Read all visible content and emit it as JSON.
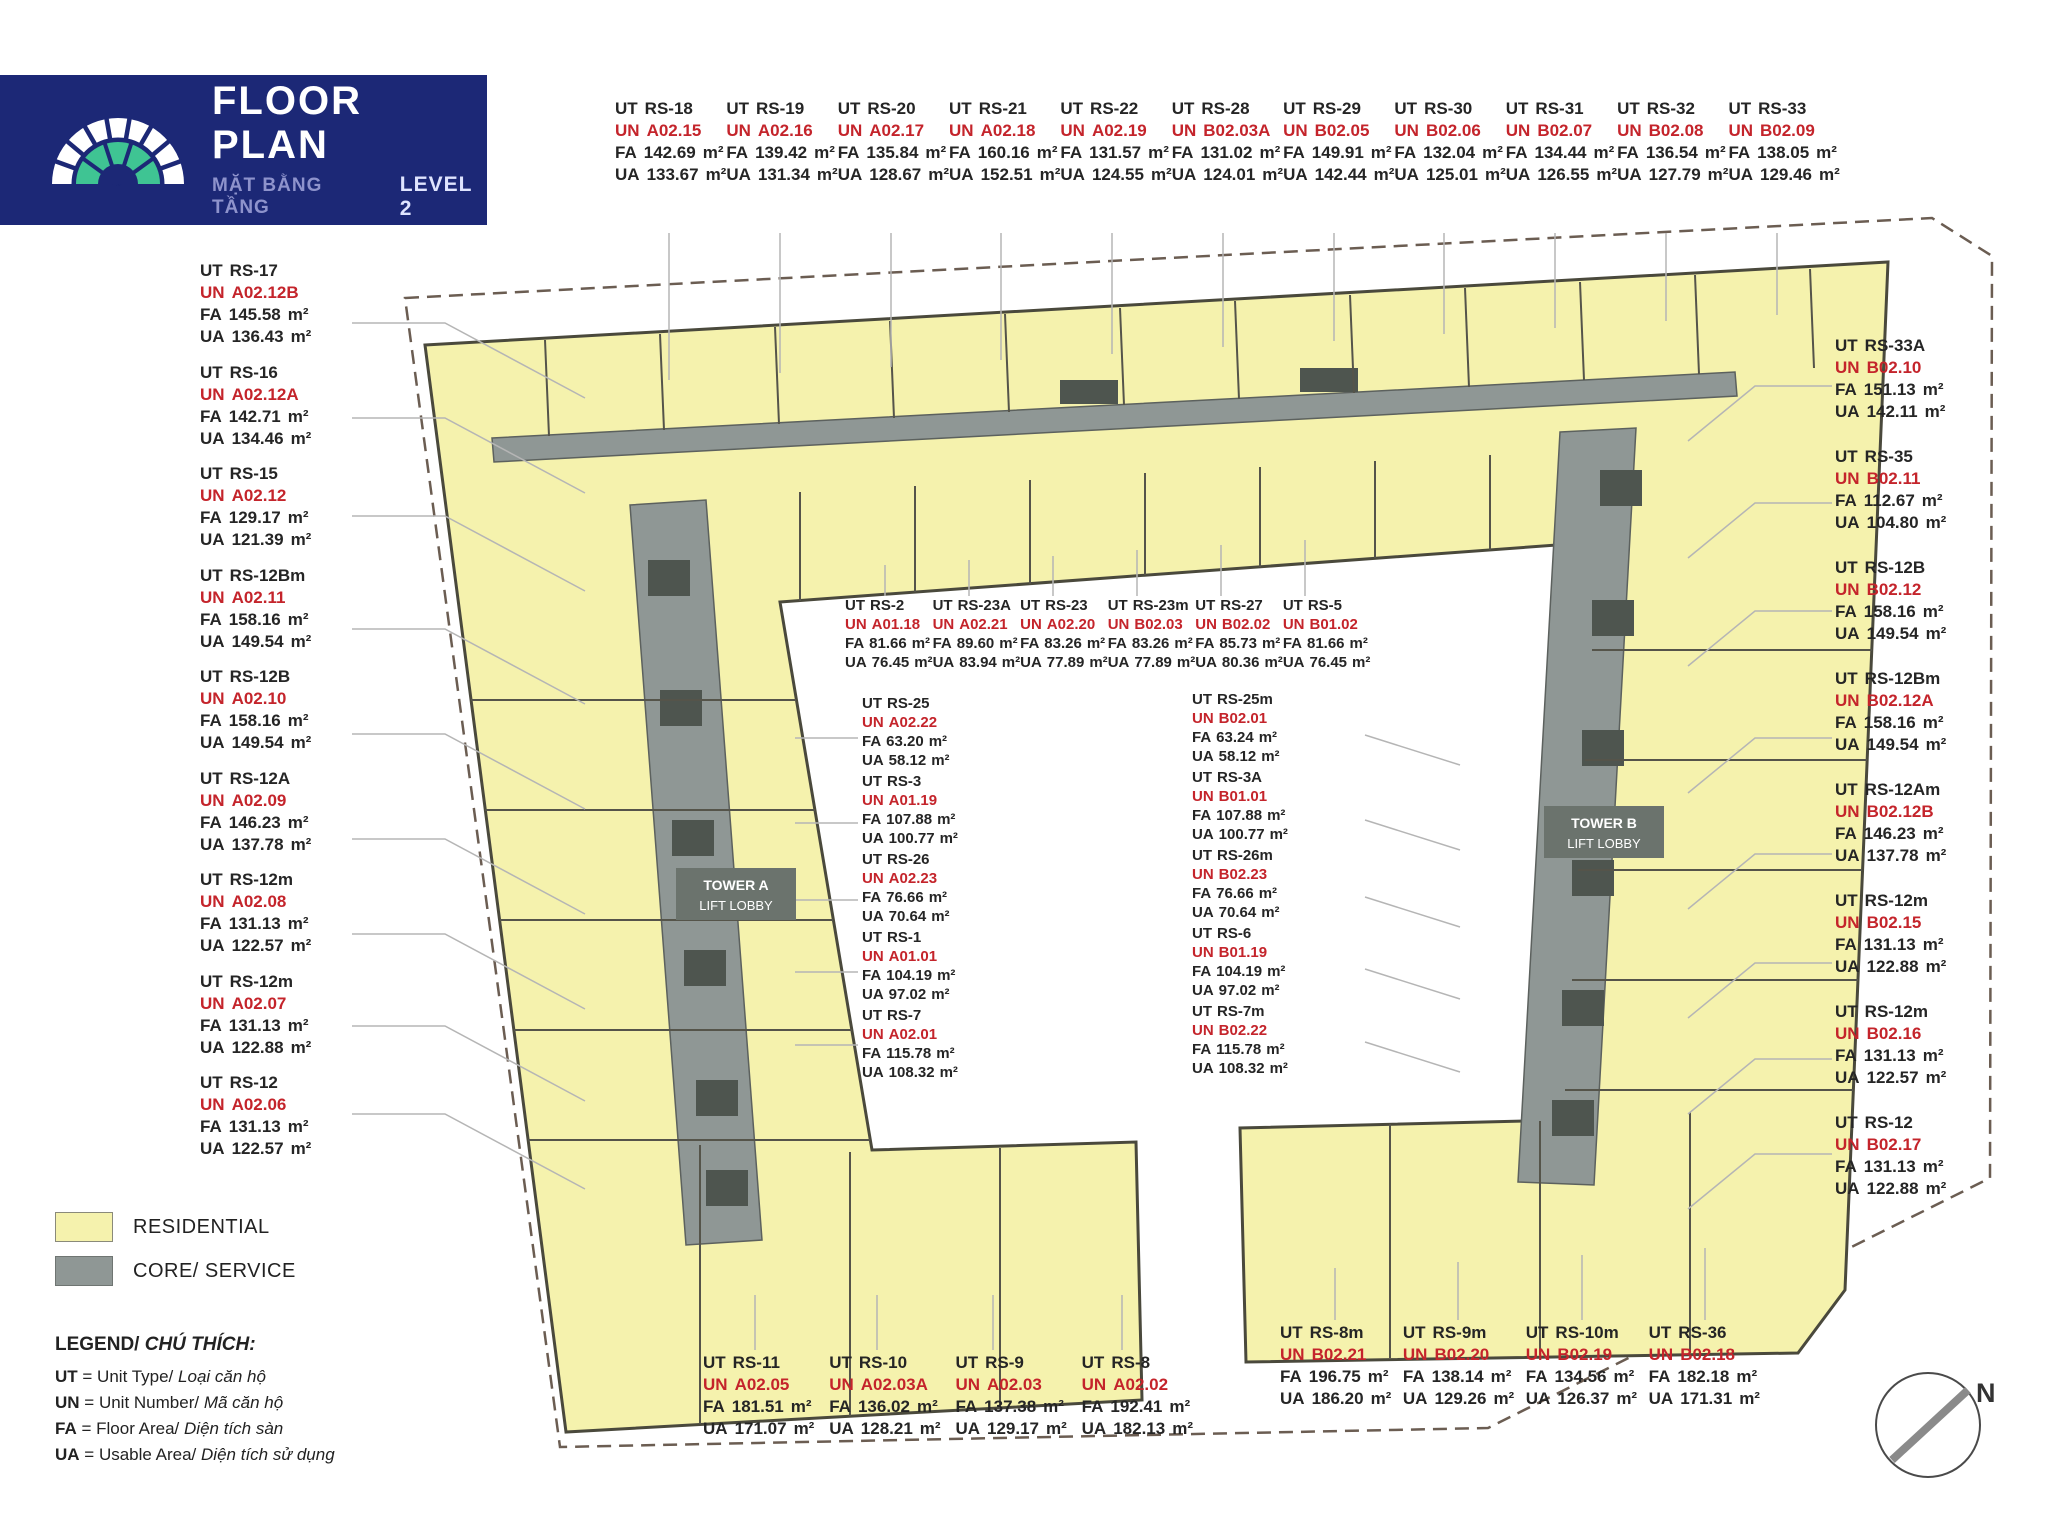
{
  "header": {
    "title": "FLOOR PLAN",
    "subtitle_vi": "MẶT BẰNG TẦNG",
    "level": "LEVEL 2"
  },
  "keys": {
    "ut": "UT",
    "un": "UN",
    "fa": "FA",
    "ua": "UA",
    "sqm": "m²"
  },
  "colors": {
    "navy": "#1c2876",
    "green": "#3fc493",
    "red": "#c4242b",
    "residential": "#f5f2ad",
    "core": "#8f9795",
    "outline": "#4a493c"
  },
  "groups": {
    "top_row": [
      {
        "ut": "RS-18",
        "un": "A02.15",
        "fa": "142.69",
        "ua": "133.67"
      },
      {
        "ut": "RS-19",
        "un": "A02.16",
        "fa": "139.42",
        "ua": "131.34"
      },
      {
        "ut": "RS-20",
        "un": "A02.17",
        "fa": "135.84",
        "ua": "128.67"
      },
      {
        "ut": "RS-21",
        "un": "A02.18",
        "fa": "160.16",
        "ua": "152.51"
      },
      {
        "ut": "RS-22",
        "un": "A02.19",
        "fa": "131.57",
        "ua": "124.55"
      },
      {
        "ut": "RS-28",
        "un": "B02.03A",
        "fa": "131.02",
        "ua": "124.01"
      },
      {
        "ut": "RS-29",
        "un": "B02.05",
        "fa": "149.91",
        "ua": "142.44"
      },
      {
        "ut": "RS-30",
        "un": "B02.06",
        "fa": "132.04",
        "ua": "125.01"
      },
      {
        "ut": "RS-31",
        "un": "B02.07",
        "fa": "134.44",
        "ua": "126.55"
      },
      {
        "ut": "RS-32",
        "un": "B02.08",
        "fa": "136.54",
        "ua": "127.79"
      },
      {
        "ut": "RS-33",
        "un": "B02.09",
        "fa": "138.05",
        "ua": "129.46"
      }
    ],
    "left_col": [
      {
        "ut": "RS-17",
        "un": "A02.12B",
        "fa": "145.58",
        "ua": "136.43"
      },
      {
        "ut": "RS-16",
        "un": "A02.12A",
        "fa": "142.71",
        "ua": "134.46"
      },
      {
        "ut": "RS-15",
        "un": "A02.12",
        "fa": "129.17",
        "ua": "121.39"
      },
      {
        "ut": "RS-12Bm",
        "un": "A02.11",
        "fa": "158.16",
        "ua": "149.54"
      },
      {
        "ut": "RS-12B",
        "un": "A02.10",
        "fa": "158.16",
        "ua": "149.54"
      },
      {
        "ut": "RS-12A",
        "un": "A02.09",
        "fa": "146.23",
        "ua": "137.78"
      },
      {
        "ut": "RS-12m",
        "un": "A02.08",
        "fa": "131.13",
        "ua": "122.57"
      },
      {
        "ut": "RS-12m",
        "un": "A02.07",
        "fa": "131.13",
        "ua": "122.88"
      },
      {
        "ut": "RS-12",
        "un": "A02.06",
        "fa": "131.13",
        "ua": "122.57"
      }
    ],
    "right_col": [
      {
        "ut": "RS-33A",
        "un": "B02.10",
        "fa": "151.13",
        "ua": "142.11"
      },
      {
        "ut": "RS-35",
        "un": "B02.11",
        "fa": "112.67",
        "ua": "104.80"
      },
      {
        "ut": "RS-12B",
        "un": "B02.12",
        "fa": "158.16",
        "ua": "149.54"
      },
      {
        "ut": "RS-12Bm",
        "un": "B02.12A",
        "fa": "158.16",
        "ua": "149.54"
      },
      {
        "ut": "RS-12Am",
        "un": "B02.12B",
        "fa": "146.23",
        "ua": "137.78"
      },
      {
        "ut": "RS-12m",
        "un": "B02.15",
        "fa": "131.13",
        "ua": "122.88"
      },
      {
        "ut": "RS-12m",
        "un": "B02.16",
        "fa": "131.13",
        "ua": "122.57"
      },
      {
        "ut": "RS-12",
        "un": "B02.17",
        "fa": "131.13",
        "ua": "122.88"
      }
    ],
    "center_top": [
      {
        "ut": "RS-2",
        "un": "A01.18",
        "fa": "81.66",
        "ua": "76.45"
      },
      {
        "ut": "RS-23A",
        "un": "A02.21",
        "fa": "89.60",
        "ua": "83.94"
      },
      {
        "ut": "RS-23",
        "un": "A02.20",
        "fa": "83.26",
        "ua": "77.89"
      },
      {
        "ut": "RS-23m",
        "un": "B02.03",
        "fa": "83.26",
        "ua": "77.89"
      },
      {
        "ut": "RS-27",
        "un": "B02.02",
        "fa": "85.73",
        "ua": "80.36"
      },
      {
        "ut": "RS-5",
        "un": "B01.02",
        "fa": "81.66",
        "ua": "76.45"
      }
    ],
    "center_left": [
      {
        "ut": "RS-25",
        "un": "A02.22",
        "fa": "63.20",
        "ua": "58.12"
      },
      {
        "ut": "RS-3",
        "un": "A01.19",
        "fa": "107.88",
        "ua": "100.77"
      },
      {
        "ut": "RS-26",
        "un": "A02.23",
        "fa": "76.66",
        "ua": "70.64"
      },
      {
        "ut": "RS-1",
        "un": "A01.01",
        "fa": "104.19",
        "ua": "97.02"
      },
      {
        "ut": "RS-7",
        "un": "A02.01",
        "fa": "115.78",
        "ua": "108.32"
      }
    ],
    "center_right": [
      {
        "ut": "RS-25m",
        "un": "B02.01",
        "fa": "63.24",
        "ua": "58.12"
      },
      {
        "ut": "RS-3A",
        "un": "B01.01",
        "fa": "107.88",
        "ua": "100.77"
      },
      {
        "ut": "RS-26m",
        "un": "B02.23",
        "fa": "76.66",
        "ua": "70.64"
      },
      {
        "ut": "RS-6",
        "un": "B01.19",
        "fa": "104.19",
        "ua": "97.02"
      },
      {
        "ut": "RS-7m",
        "un": "B02.22",
        "fa": "115.78",
        "ua": "108.32"
      }
    ],
    "bottom_left": [
      {
        "ut": "RS-11",
        "un": "A02.05",
        "fa": "181.51",
        "ua": "171.07"
      },
      {
        "ut": "RS-10",
        "un": "A02.03A",
        "fa": "136.02",
        "ua": "128.21"
      },
      {
        "ut": "RS-9",
        "un": "A02.03",
        "fa": "137.38",
        "ua": "129.17"
      },
      {
        "ut": "RS-8",
        "un": "A02.02",
        "fa": "192.41",
        "ua": "182.13"
      }
    ],
    "bottom_right": [
      {
        "ut": "RS-8m",
        "un": "B02.21",
        "fa": "196.75",
        "ua": "186.20"
      },
      {
        "ut": "RS-9m",
        "un": "B02.20",
        "fa": "138.14",
        "ua": "129.26"
      },
      {
        "ut": "RS-10m",
        "un": "B02.19",
        "fa": "134.56",
        "ua": "126.37"
      },
      {
        "ut": "RS-36",
        "un": "B02.18",
        "fa": "182.18",
        "ua": "171.31"
      }
    ]
  },
  "plan": {
    "tower_a": {
      "line1": "TOWER A",
      "line2": "LIFT LOBBY"
    },
    "tower_b": {
      "line1": "TOWER B",
      "line2": "LIFT LOBBY"
    }
  },
  "legend": {
    "residential": "RESIDENTIAL",
    "core": "CORE/ SERVICE",
    "title_en": "LEGEND/",
    "title_vi": "CHÚ THÍCH:",
    "items": [
      {
        "k": "UT",
        "en": "= Unit Type/",
        "vi": "Loại căn hộ"
      },
      {
        "k": "UN",
        "en": "= Unit Number/",
        "vi": "Mã căn hộ"
      },
      {
        "k": "FA",
        "en": "= Floor Area/",
        "vi": "Diện tích sàn"
      },
      {
        "k": "UA",
        "en": "= Usable Area/",
        "vi": "Diện tích sử dụng"
      }
    ]
  },
  "compass": {
    "label": "N"
  }
}
